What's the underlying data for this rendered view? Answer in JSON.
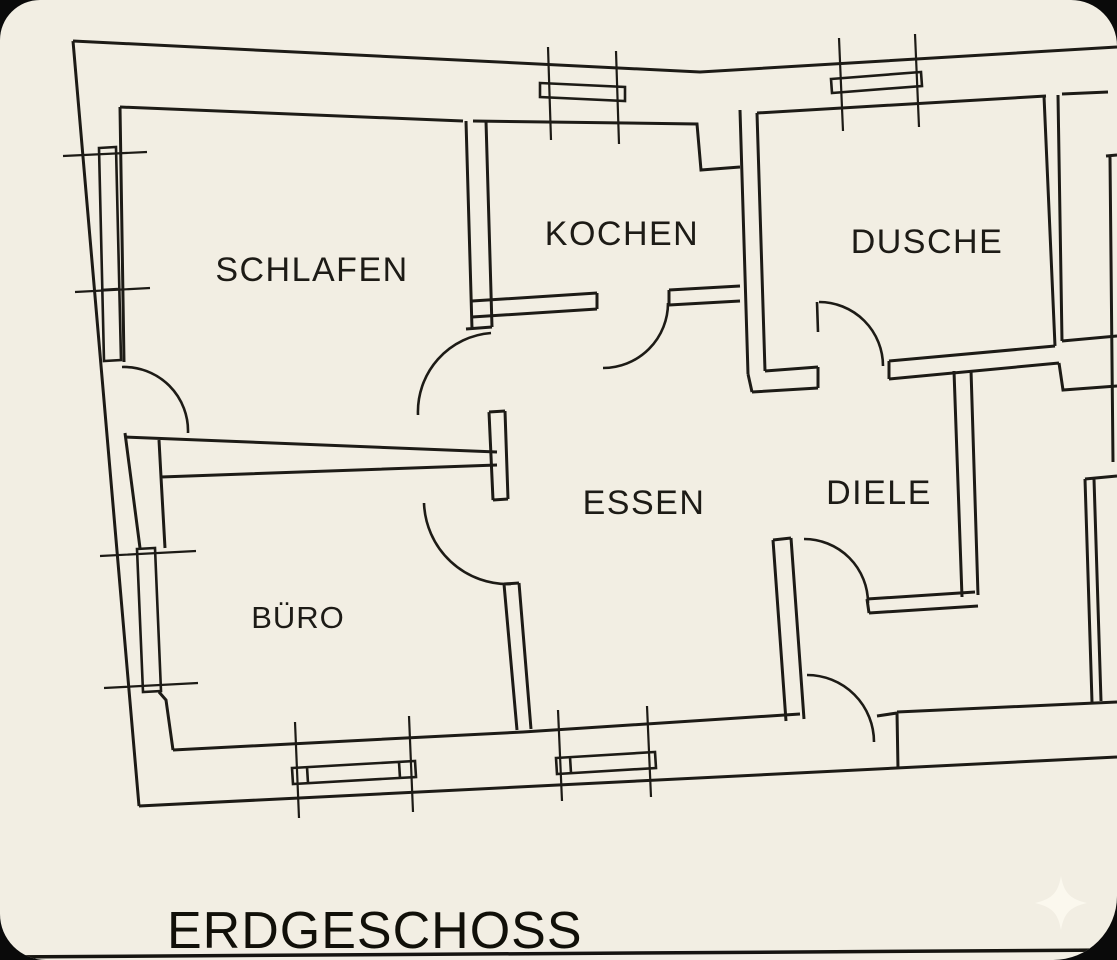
{
  "title": "ERDGESCHOSS",
  "rooms": [
    {
      "name": "schlafen",
      "label": "SCHLAFEN"
    },
    {
      "name": "kochen",
      "label": "KOCHEN"
    },
    {
      "name": "dusche",
      "label": "DUSCHE"
    },
    {
      "name": "essen",
      "label": "ESSEN"
    },
    {
      "name": "diele",
      "label": "DIELE"
    },
    {
      "name": "buero",
      "label": "BÜRO"
    }
  ],
  "colors": {
    "paper": "#f2eee3",
    "ink": "#1d1b16",
    "outside": "#0a0a0a",
    "sparkle": "#fbf8ee"
  },
  "icons": {
    "sparkle": "four-pointed-star"
  }
}
